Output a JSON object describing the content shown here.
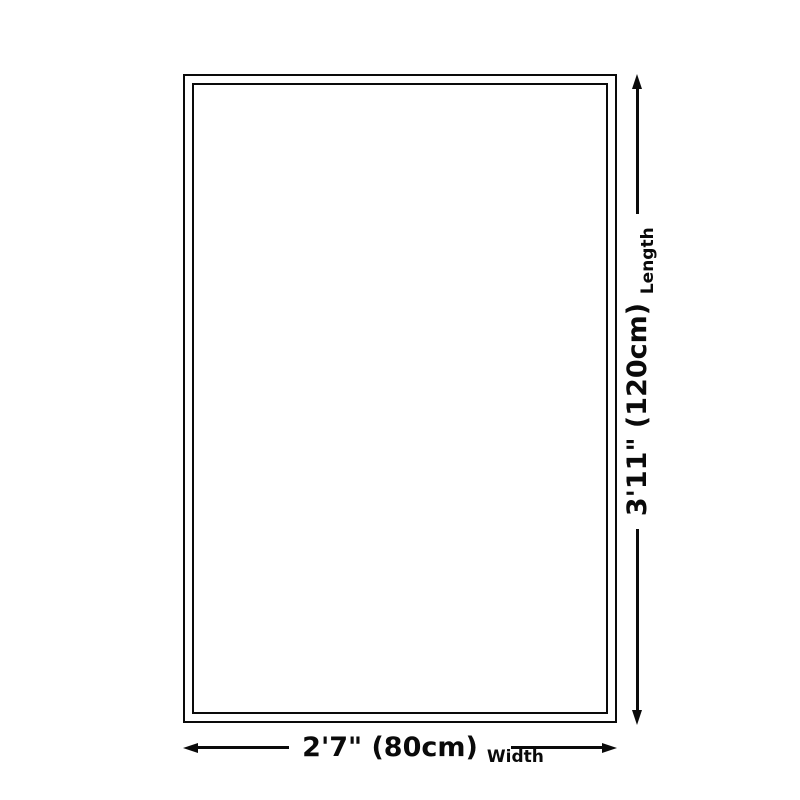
{
  "diagram": {
    "dimensions": {
      "length": {
        "value": "3'11\" (120cm)",
        "label": "Length"
      },
      "width": {
        "value": "2'7\" (80cm)",
        "label": "Width"
      }
    },
    "colors": {
      "line": "#0a0a0a",
      "background": "#ffffff"
    }
  }
}
